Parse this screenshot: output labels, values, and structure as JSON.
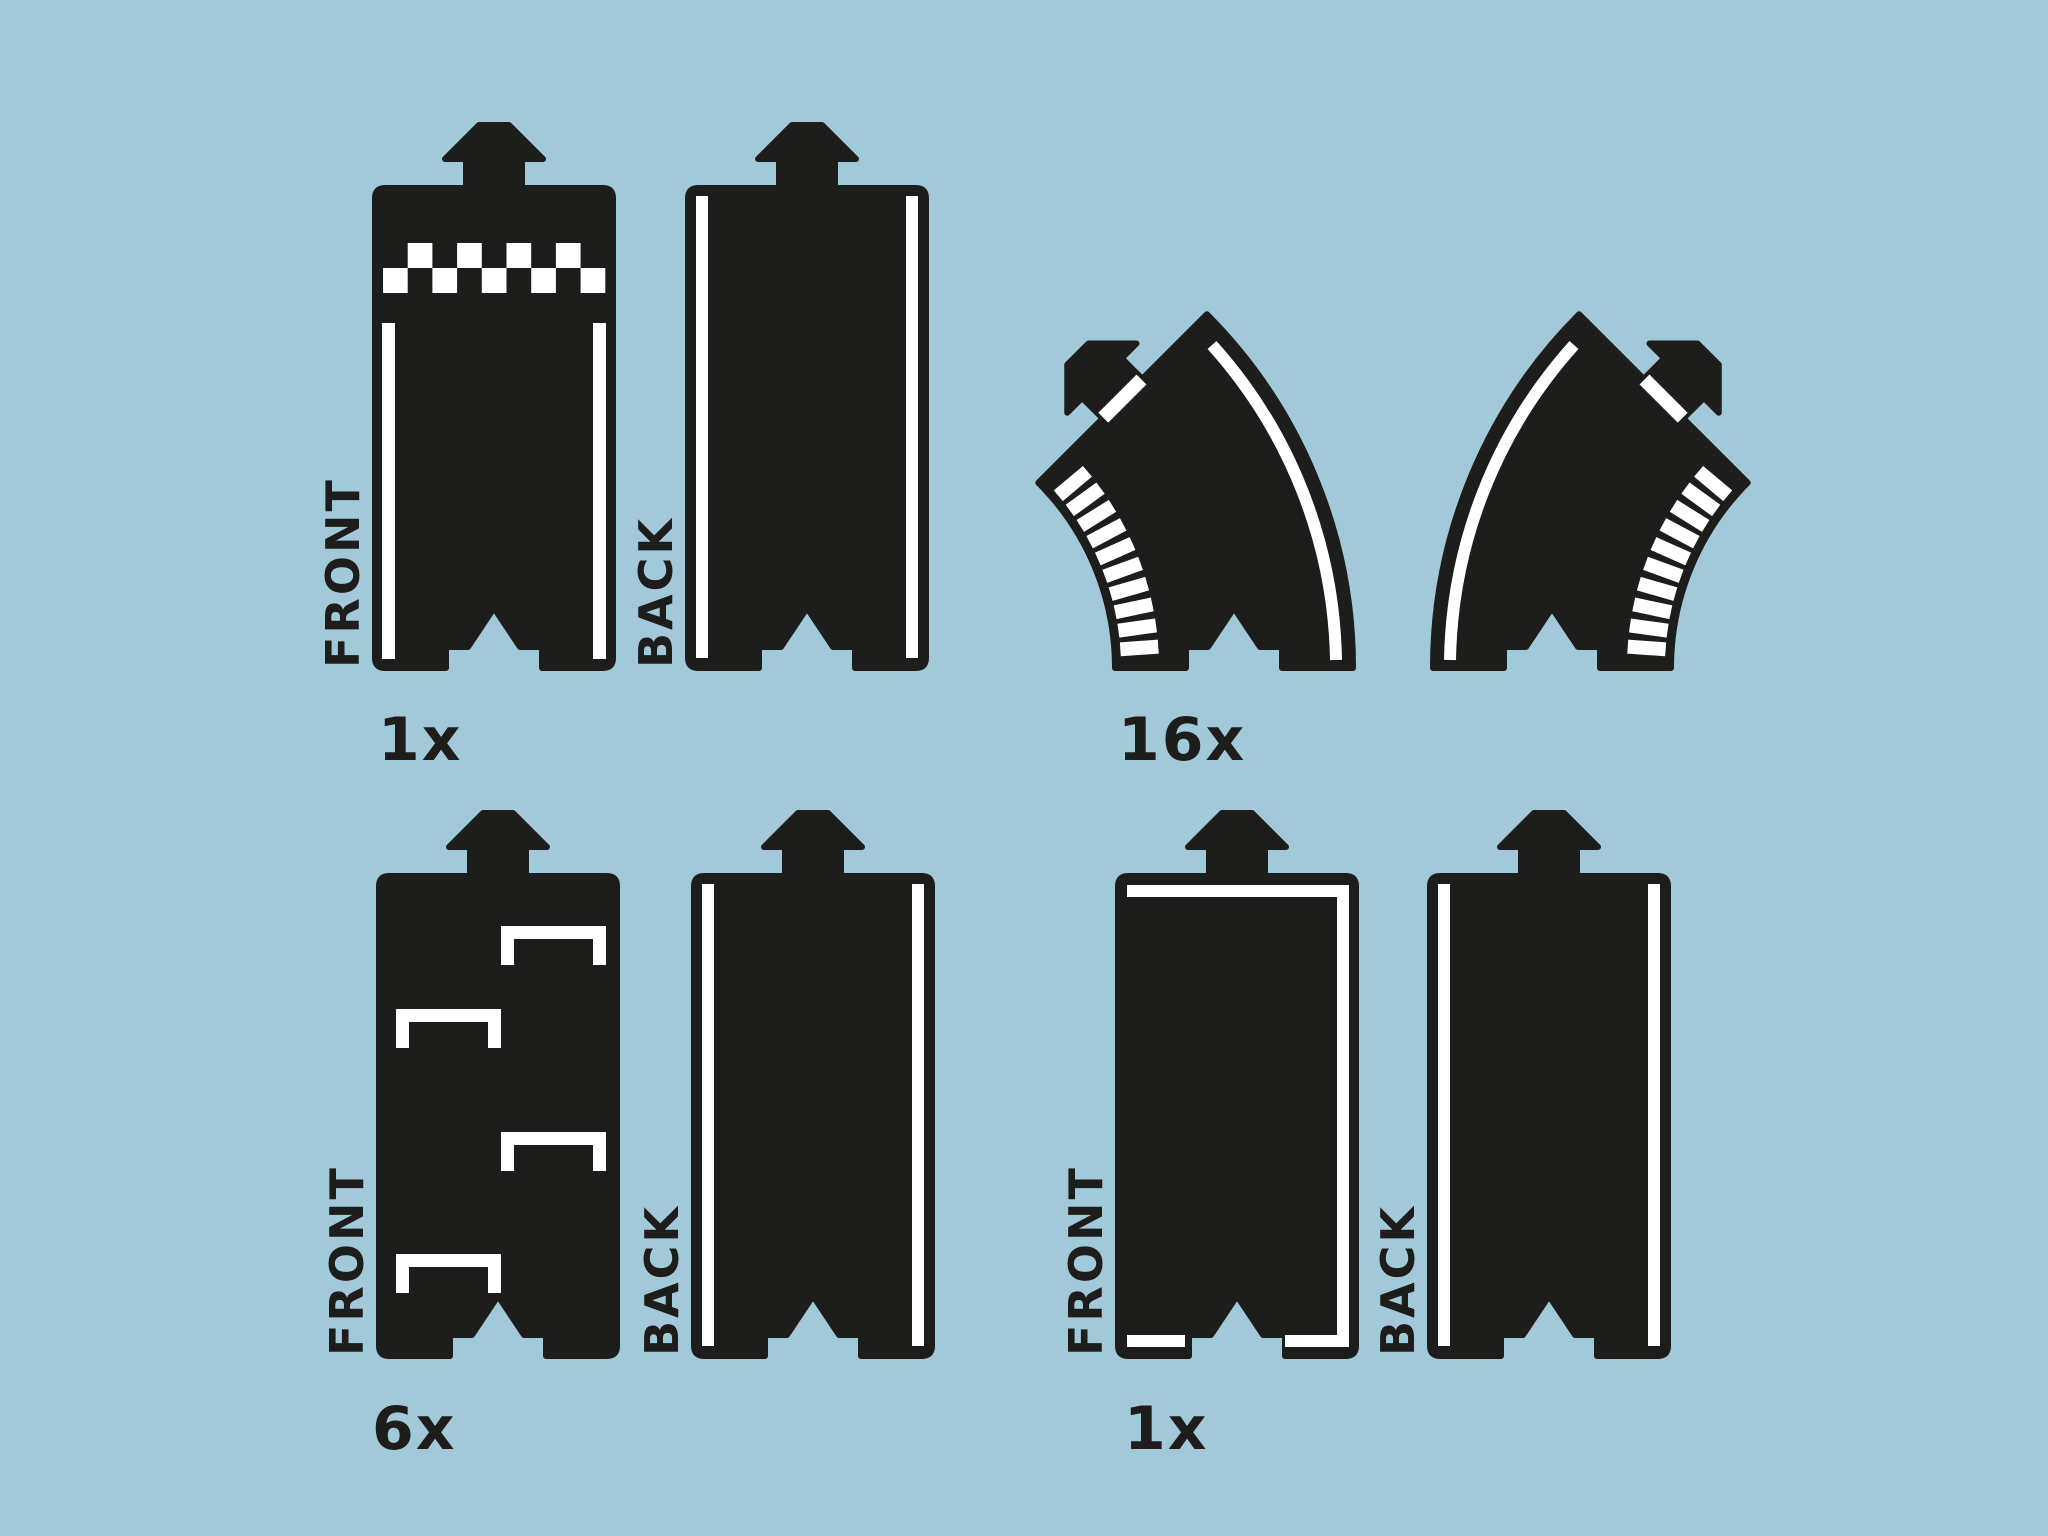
{
  "colors": {
    "background": "#a2c9d7",
    "piece": "#1d1d1b",
    "marking": "#ffffff"
  },
  "groups": [
    {
      "id": "start-finish-straight",
      "count": "1x",
      "front_label": "FRONT",
      "back_label": "BACK"
    },
    {
      "id": "curve-pair",
      "count": "16x"
    },
    {
      "id": "marked-straight",
      "count": "6x",
      "front_label": "FRONT",
      "back_label": "BACK"
    },
    {
      "id": "bordered-straight",
      "count": "1x",
      "front_label": "FRONT",
      "back_label": "BACK"
    }
  ]
}
